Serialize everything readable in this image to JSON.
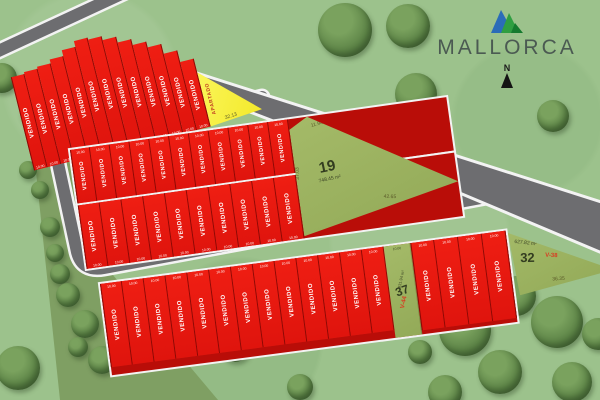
{
  "branding": {
    "name": "MALLORCA",
    "compass_label": "N"
  },
  "legend": {
    "sold_label": "VENDIDO",
    "reserved_label": "APARTADO"
  },
  "measure_default": "10.00",
  "blocks": {
    "top": {
      "sold_count": 13
    },
    "middle": {
      "row1_sold_count": 11,
      "row2_sold_count": 10
    },
    "bottom": {
      "left_sold_count": 13,
      "right_sold_count": 4
    }
  },
  "lots": {
    "reserved": {
      "label": "APARTADO",
      "edge_top": "25.94",
      "edge_bottom": "32.13"
    },
    "lot19": {
      "number": "19",
      "area": "748.45 m²",
      "edge_top": "11.94",
      "edge_right": "42.38",
      "edge_bottom": "42.65",
      "edge_left": "37.03"
    },
    "lot37": {
      "number": "37",
      "area": "931.94 m²",
      "code": "V-44",
      "edge_top": "10.00"
    },
    "lot32": {
      "number": "32",
      "area": "627.82 m²",
      "code": "V-38",
      "edge_top": "45.67",
      "edge_bottom": "36.35"
    }
  },
  "colors": {
    "sold": "#df140d",
    "reserved": "#f3e92a",
    "available": "#93aa58",
    "grass": "#9cc28c",
    "road": "#6d6d70",
    "road_line": "#f3f3f3",
    "strip": "#7f9f63"
  }
}
